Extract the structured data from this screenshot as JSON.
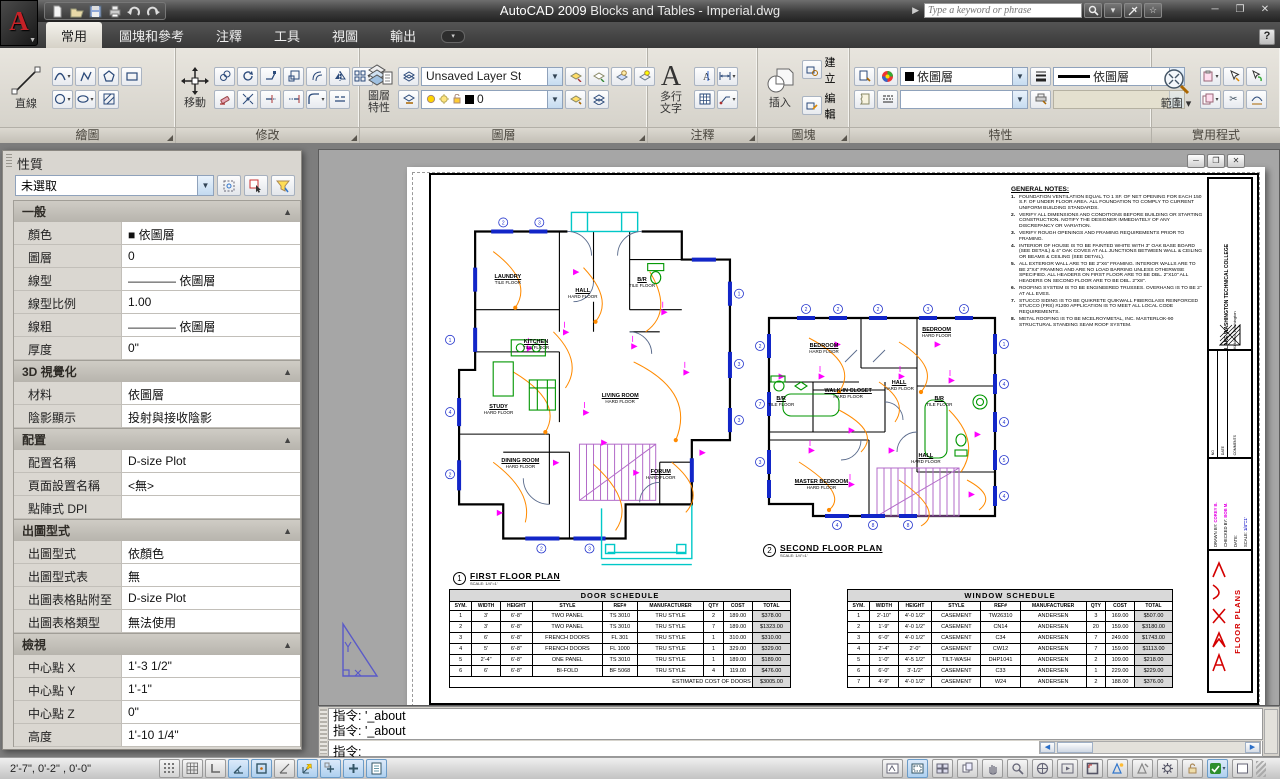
{
  "title_bar": {
    "logo_letter": "A",
    "app_name": "AutoCAD 2009",
    "doc_name": " Blocks and Tables - Imperial.dwg",
    "search": {
      "placeholder": "Type a keyword or phrase"
    },
    "window": {
      "minimize": "─",
      "maximize": "❐",
      "close": "✕"
    }
  },
  "ribbon": {
    "tabs": [
      {
        "label": "常用"
      },
      {
        "label": "圖塊和參考"
      },
      {
        "label": "注釋"
      },
      {
        "label": "工具"
      },
      {
        "label": "視圖"
      },
      {
        "label": "輸出"
      }
    ],
    "help_label": "?",
    "panels": {
      "draw": {
        "caption": "繪圖",
        "line_label": "直線"
      },
      "modify": {
        "caption": "修改",
        "move_label": "移動"
      },
      "layers": {
        "caption": "圖層",
        "big_label_1": "圖層",
        "big_label_2": "特性",
        "layer_state_value": "Unsaved Layer St",
        "current_layer": "0"
      },
      "annotate": {
        "caption": "注釋",
        "mtext_label_1": "多行",
        "mtext_label_2": "文字"
      },
      "block": {
        "caption": "圖塊",
        "insert_label": "插入",
        "create_label": "建立",
        "edit_label": "編輯"
      },
      "props": {
        "caption": "特性",
        "color_value": "依圖層",
        "lineweight_value": "依圖層"
      },
      "utils": {
        "caption": "實用程式",
        "extents_label": "範圍"
      }
    }
  },
  "palette": {
    "title": "性質",
    "selection_value": "未選取",
    "sections": [
      {
        "title": "一般",
        "rows": [
          {
            "label": "顏色",
            "value": "■ 依圖層"
          },
          {
            "label": "圖層",
            "value": "0"
          },
          {
            "label": "線型",
            "value": "———— 依圖層"
          },
          {
            "label": "線型比例",
            "value": "1.00"
          },
          {
            "label": "線粗",
            "value": "———— 依圖層"
          },
          {
            "label": "厚度",
            "value": "0\""
          }
        ]
      },
      {
        "title": "3D 視覺化",
        "rows": [
          {
            "label": "材料",
            "value": "依圖層"
          },
          {
            "label": "陰影顯示",
            "value": "投射與接收陰影"
          }
        ]
      },
      {
        "title": "配置",
        "rows": [
          {
            "label": "配置名稱",
            "value": "D-size Plot"
          },
          {
            "label": "頁面設置名稱",
            "value": "<無>"
          },
          {
            "label": "點陣式 DPI",
            "value": ""
          }
        ]
      },
      {
        "title": "出圖型式",
        "rows": [
          {
            "label": "出圖型式",
            "value": "依顏色"
          },
          {
            "label": "出圖型式表",
            "value": "無"
          },
          {
            "label": "出圖表格貼附至",
            "value": "D-size Plot"
          },
          {
            "label": "出圖表格類型",
            "value": "無法使用"
          }
        ]
      },
      {
        "title": "檢視",
        "rows": [
          {
            "label": "中心點 X",
            "value": "1'-3 1/2\""
          },
          {
            "label": "中心點 Y",
            "value": "1'-1\""
          },
          {
            "label": "中心點 Z",
            "value": "0\""
          },
          {
            "label": "高度",
            "value": "1'-10 1/4\""
          }
        ]
      }
    ]
  },
  "drawing": {
    "notes": {
      "title": "GENERAL NOTES:",
      "items": [
        "FOUNDATION VENTILATION EQUAL TO 1 SF. OF NET OPENING FOR EACH 150 S.F. OF UNDER FLOOR AREA. ALL FOUNDATION TO COMPLY TO CURRENT UNIFORM BUILDING STANDARDS.",
        "VERIFY ALL DIMENSIONS AND CONDITIONS BEFORE BUILDING OR STARTING CONSTRUCTION. NOTIFY THE DESIGNER IMMEDIATELY OF ANY DISCREPANCY OR VARIATION.",
        "VERIFY ROUGH OPENINGS AND FRAMING REQUIREMENTS PRIOR TO FRAMING.",
        "INTERIOR OF HOUSE IS TO BE PAINTED WHITE WITH 3\" OAK BASE BOARD (SEE DETAIL) & 4\" OAK COVES AT ALL JUNCTIONS BETWEEN WALL & CEILING OR BEAMS & CEILING (SEE DETAIL).",
        "ALL EXTERIOR WALL ARE TO BE 2\"X6\" FRAMING. INTERIOR WALLS ARE TO BE 2\"X4\" FRAMING AND ARE NO LOAD BARRING UNLESS OTHERWISE SPECIFIED. ALL HEADERS ON FIRST FLOOR ARE TO BE DBL. 2\"X10\" ALL HEADERS ON SECOND FLOOR ARE TO BE DBL. 2\"X8\".",
        "ROOFING SYSTEM IS TO BE ENGINEERED TRUSSES. OVERHANG IS TO BE 2\" AT ALL EVES.",
        "STUCCO SIDING IS TO BE QUIKRETE QUIKWALL FIBERGLASS REINFORCED STUCCO (FRS) #1200 APPLICATION IS TO MEET ALL LOCAL CODE REQUIREMENTS.",
        "METAL ROOFING IS TO BE MCELROYMETAL, INC. MASTERLOK-90 STRUCTURAL STANDING SEAM ROOF SYSTEM."
      ]
    },
    "plan1": {
      "callout": "1",
      "label": "FIRST FLOOR PLAN",
      "scale": "SCALE: 1/4\"=1'",
      "rooms": [
        {
          "name": "LAUNDRY",
          "floor": "TILE FLOOR",
          "x": 24,
          "y": 19
        },
        {
          "name": "HALL",
          "floor": "HARD FLOOR",
          "x": 48,
          "y": 23
        },
        {
          "name": "B/R",
          "floor": "TILE FLOOR",
          "x": 67,
          "y": 20
        },
        {
          "name": "KITCHEN",
          "floor": "TILE FLOOR",
          "x": 33,
          "y": 37
        },
        {
          "name": "STUDY",
          "floor": "HARD FLOOR",
          "x": 21,
          "y": 55
        },
        {
          "name": "LIVING ROOM",
          "floor": "HARD FLOOR",
          "x": 60,
          "y": 52
        },
        {
          "name": "DINING ROOM",
          "floor": "HARD FLOOR",
          "x": 28,
          "y": 70
        },
        {
          "name": "FORUM",
          "floor": "HARD FLOOR",
          "x": 73,
          "y": 73
        }
      ]
    },
    "plan2": {
      "callout": "2",
      "label": "SECOND FLOOR PLAN",
      "scale": "SCALE: 1/4\"=1'",
      "rooms": [
        {
          "name": "BEDROOM",
          "floor": "HARD FLOOR",
          "x": 28,
          "y": 26
        },
        {
          "name": "BEDROOM",
          "floor": "HARD FLOOR",
          "x": 70,
          "y": 20
        },
        {
          "name": "WALK-IN CLOSET",
          "floor": "HARD FLOOR",
          "x": 37,
          "y": 43
        },
        {
          "name": "HALL",
          "floor": "HARD FLOOR",
          "x": 56,
          "y": 40
        },
        {
          "name": "B/R",
          "floor": "TILE FLOOR",
          "x": 12,
          "y": 46
        },
        {
          "name": "B/R",
          "floor": "TILE FLOOR",
          "x": 71,
          "y": 46
        },
        {
          "name": "MASTER BEDROOM",
          "floor": "HARD FLOOR",
          "x": 27,
          "y": 77
        },
        {
          "name": "HALL",
          "floor": "HARD FLOOR",
          "x": 66,
          "y": 67
        }
      ]
    },
    "door_schedule": {
      "title": "DOOR SCHEDULE",
      "headers": [
        "SYM.",
        "WIDTH",
        "HEIGHT",
        "STYLE",
        "REF#",
        "MANUFACTURER",
        "QTY",
        "COST",
        "TOTAL"
      ],
      "rows": [
        [
          "1",
          "3'",
          "6'-8\"",
          "TWO PANEL",
          "TS 3010",
          "TRU STYLE",
          "2",
          "189.00",
          "$378.00"
        ],
        [
          "2",
          "3'",
          "6'-8\"",
          "TWO PANEL",
          "TS 3010",
          "TRU STYLE",
          "7",
          "189.00",
          "$1323.00"
        ],
        [
          "3",
          "6'",
          "6'-8\"",
          "FRENCH DOORS",
          "FL 301",
          "TRU STYLE",
          "1",
          "310.00",
          "$310.00"
        ],
        [
          "4",
          "5'",
          "6'-8\"",
          "FRENCH DOORS",
          "FL 1000",
          "TRU STYLE",
          "1",
          "329.00",
          "$329.00"
        ],
        [
          "5",
          "2'-4\"",
          "6'-8\"",
          "ONE PANEL",
          "TS 3010",
          "TRU STYLE",
          "1",
          "189.00",
          "$189.00"
        ],
        [
          "6",
          "6'",
          "6'-8\"",
          "BI-FOLD",
          "BF 5068",
          "TRU STYLE",
          "4",
          "119.00",
          "$476.00"
        ]
      ],
      "footer_label": "ESTIMATED COST OF DOORS",
      "footer_value": "$3005.00"
    },
    "window_schedule": {
      "title": "WINDOW SCHEDULE",
      "headers": [
        "SYM.",
        "WIDTH",
        "HEIGHT",
        "STYLE",
        "REF#",
        "MANUFACTURER",
        "QTY",
        "COST",
        "TOTAL"
      ],
      "rows": [
        [
          "1",
          "2'-10\"",
          "4'-0 1/2\"",
          "CASEMENT",
          "TW26310",
          "ANDERSEN",
          "3",
          "169.00",
          "$507.00"
        ],
        [
          "2",
          "1'-9\"",
          "4'-0 1/2\"",
          "CASEMENT",
          "CN14",
          "ANDERSEN",
          "20",
          "159.00",
          "$3180.00"
        ],
        [
          "3",
          "6'-0\"",
          "4'-0 1/2\"",
          "CASEMENT",
          "C34",
          "ANDERSEN",
          "7",
          "249.00",
          "$1743.00"
        ],
        [
          "4",
          "2'-4\"",
          "2'-0\"",
          "CASEMENT",
          "CW12",
          "ANDERSEN",
          "7",
          "159.00",
          "$1113.00"
        ],
        [
          "5",
          "1'-0\"",
          "4'-5 1/2\"",
          "TILT-WASH",
          "DHP1041",
          "ANDERSEN",
          "2",
          "109.00",
          "$218.00"
        ],
        [
          "6",
          "6'-0\"",
          "3'-1/2\"",
          "CASEMENT",
          "C33",
          "ANDERSEN",
          "1",
          "229.00",
          "$229.00"
        ],
        [
          "7",
          "4'-9\"",
          "4'-0 1/2\"",
          "CASEMENT",
          "W24",
          "ANDERSEN",
          "2",
          "188.00",
          "$376.00"
        ]
      ]
    },
    "title_block": {
      "college": "LAKE WASHINGTON TECHNICAL COLLEGE",
      "city": "Kirkland, Washington",
      "no_label": "NO",
      "date_label": "DATE",
      "comments_label": "COMMENTS",
      "drawn_label": "DRAWN BY:",
      "drawn_value": "COREY B.",
      "checked_label": "CHECKED BY:",
      "checked_value": "BOB M.",
      "date2_label": "DATE:",
      "scale_label": "SCALE:",
      "scale_value": "1/4\"=1'",
      "sheet_title": "FLOOR PLANS"
    }
  },
  "command": {
    "history": [
      "指令: '_about",
      "指令: '_about"
    ],
    "prompt": "指令:"
  },
  "status": {
    "coords": "2'-7\",    0'-2\"  , 0'-0\""
  }
}
